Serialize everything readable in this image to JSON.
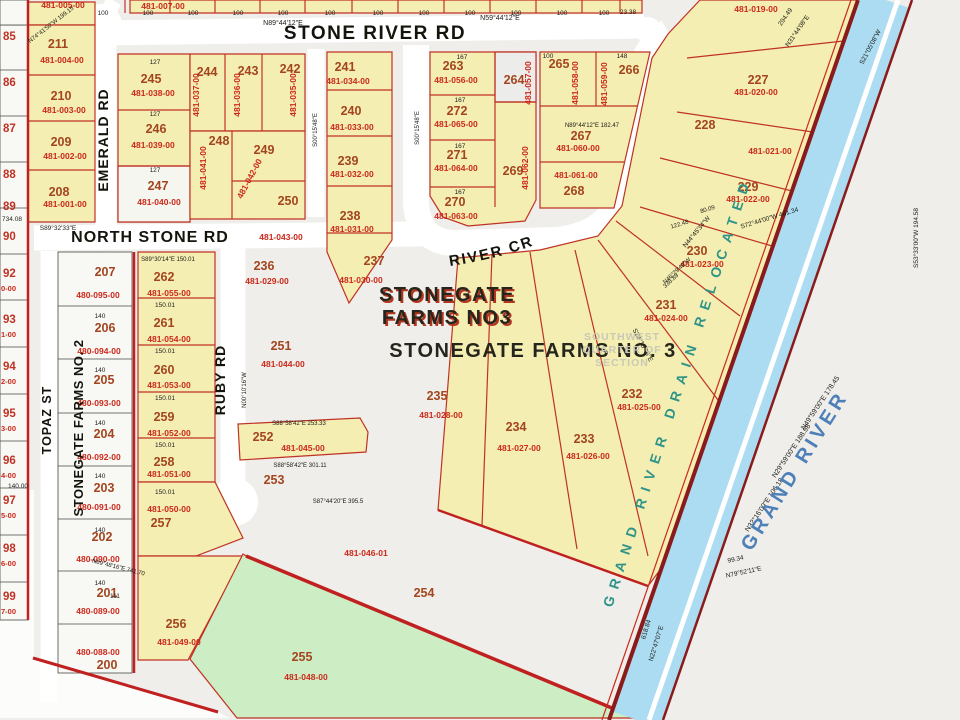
{
  "map": {
    "colors": {
      "parcel_yellow": "#f4eeb2",
      "parcel_green": "#cdeec5",
      "parcel_gray": "#ececea",
      "parcel_white": "#f8f8f5",
      "boundary_red": "#c03224",
      "thick_red": "#c02020",
      "river_blue": "#abdcf2",
      "bank_maroon": "#8b1a1a",
      "road_white": "#ffffff",
      "lot_number_color": "#a3451f",
      "parcel_id_color": "#cc291a",
      "river_label_color": "#4d80b8",
      "drain_label_color": "#2f9488"
    },
    "road_names": {
      "stone_river": "STONE RIVER RD",
      "north_stone": "NORTH STONE RD",
      "emerald": "EMERALD RD",
      "ruby": "RUBY RD",
      "topaz": "TOPAZ ST",
      "grand_river_cr": "GRAND RIVER CR"
    },
    "subdivision_labels": {
      "no3_line1": "STONEGATE",
      "no3_line2": "FARMS NO3",
      "no3_full": "STONEGATE FARMS NO. 3",
      "no2": "STONEGATE FARMS NO. 2",
      "quarter": [
        "SOUTHWEST",
        "QUARTER OF",
        "SECTION"
      ],
      "river": "GRAND RIVER",
      "drain": "GRAND RIVER DRAIN RELOCATED"
    },
    "parcels": [
      [
        "211",
        58,
        48,
        "481-004-00",
        62,
        63,
        0
      ],
      [
        "210",
        61,
        100,
        "481-003-00",
        64,
        113,
        0
      ],
      [
        "209",
        61,
        146,
        "481-002-00",
        65,
        159,
        0
      ],
      [
        "208",
        59,
        196,
        "481-001-00",
        65,
        207,
        0
      ],
      [
        "245",
        151,
        83,
        "481-038-00",
        153,
        96,
        0
      ],
      [
        "246",
        156,
        133,
        "481-039-00",
        153,
        148,
        0
      ],
      [
        "247",
        158,
        190,
        "481-040-00",
        159,
        205,
        0
      ],
      [
        "244",
        207,
        76,
        "481-037-00",
        199,
        95,
        -90
      ],
      [
        "243",
        248,
        75,
        "481-036-00",
        240,
        95,
        -90
      ],
      [
        "242",
        290,
        73,
        "481-035-00",
        296,
        95,
        -90
      ],
      [
        "248",
        219,
        145,
        "481-041-00",
        206,
        168,
        -90
      ],
      [
        "249",
        264,
        154,
        "481-042-00",
        252,
        180,
        -62
      ],
      [
        "250",
        288,
        205,
        "481-043-00",
        281,
        240,
        0
      ],
      [
        "241",
        345,
        71,
        "481-034-00",
        348,
        84,
        0
      ],
      [
        "240",
        351,
        115,
        "481-033-00",
        352,
        130,
        0
      ],
      [
        "239",
        348,
        165,
        "481-032-00",
        352,
        177,
        0
      ],
      [
        "238",
        350,
        220,
        "481-031-00",
        352,
        232,
        0
      ],
      [
        "237",
        374,
        265,
        "481-030-00",
        361,
        283,
        0
      ],
      [
        "236",
        264,
        270,
        "481-029-00",
        267,
        284,
        0
      ],
      [
        "263",
        453,
        70,
        "481-056-00",
        456,
        83,
        0
      ],
      [
        "272",
        457,
        115,
        "481-065-00",
        456,
        127,
        0
      ],
      [
        "271",
        457,
        159,
        "481-064-00",
        456,
        171,
        0
      ],
      [
        "270",
        455,
        206,
        "481-063-00",
        456,
        219,
        0
      ],
      [
        "264",
        514,
        84,
        "481-057-00",
        531,
        83,
        -90
      ],
      [
        "269",
        513,
        175,
        "481-062-00",
        528,
        168,
        -90
      ],
      [
        "265",
        559,
        68,
        "481-058-00",
        578,
        83,
        -90
      ],
      [
        "266",
        629,
        74,
        "481-059-00",
        607,
        84,
        -90
      ],
      [
        "267",
        581,
        140,
        "481-060-00",
        578,
        151,
        0
      ],
      [
        "268",
        574,
        195,
        "481-061-00",
        576,
        178,
        0
      ],
      [
        "227",
        758,
        84,
        "481-020-00",
        756,
        95,
        0
      ],
      [
        "228",
        705,
        129,
        "481-021-00",
        770,
        154,
        0
      ],
      [
        "229",
        748,
        191,
        "481-022-00",
        748,
        202,
        0
      ],
      [
        "230",
        697,
        255,
        "481-023-00",
        702,
        267,
        0
      ],
      [
        "231",
        666,
        309,
        "481-024-00",
        666,
        321,
        0
      ],
      [
        "232",
        632,
        398,
        "481-025-00",
        639,
        410,
        0
      ],
      [
        "233",
        584,
        443,
        "481-026-00",
        588,
        459,
        0
      ],
      [
        "234",
        516,
        431,
        "481-027-00",
        519,
        451,
        0
      ],
      [
        "235",
        437,
        400,
        "481-028-00",
        441,
        418,
        0
      ],
      [
        "262",
        164,
        281,
        "481-055-00",
        169,
        296,
        0
      ],
      [
        "261",
        164,
        327,
        "481-054-00",
        169,
        342,
        0
      ],
      [
        "260",
        164,
        374,
        "481-053-00",
        169,
        388,
        0
      ],
      [
        "259",
        164,
        421,
        "481-052-00",
        169,
        436,
        0
      ],
      [
        "258",
        164,
        466,
        "481-051-00",
        169,
        477,
        0
      ],
      [
        "257",
        161,
        527,
        "481-050-00",
        169,
        512,
        0
      ],
      [
        "256",
        176,
        628,
        "481-049-00",
        179,
        645,
        0
      ],
      [
        "255",
        302,
        661,
        "481-048-00",
        306,
        680,
        0
      ],
      [
        "252",
        263,
        441,
        "481-045-00",
        303,
        451,
        0
      ],
      [
        "251",
        281,
        350,
        "481-044-00",
        283,
        367,
        0
      ],
      [
        "253",
        274,
        484,
        "",
        0,
        0,
        0
      ],
      [
        "254",
        424,
        597,
        "",
        0,
        0,
        0
      ],
      [
        "207",
        105,
        276,
        "480-095-00",
        98,
        298,
        0
      ],
      [
        "206",
        105,
        332,
        "480-094-00",
        99,
        354,
        0
      ],
      [
        "205",
        104,
        384,
        "480-093-00",
        99,
        406,
        0
      ],
      [
        "204",
        104,
        438,
        "480-092-00",
        99,
        460,
        0
      ],
      [
        "203",
        104,
        492,
        "480-091-00",
        99,
        510,
        0
      ],
      [
        "202",
        102,
        541,
        "480-090-00",
        98,
        562,
        0
      ],
      [
        "201",
        107,
        597,
        "480-089-00",
        98,
        614,
        0
      ],
      [
        "200",
        107,
        669,
        "480-088-00",
        98,
        655,
        0
      ],
      [
        "",
        0,
        0,
        "481-005-00",
        63,
        8,
        0
      ],
      [
        "",
        0,
        0,
        "481-007-00",
        163,
        9,
        0
      ],
      [
        "",
        0,
        0,
        "481-019-00",
        756,
        12,
        0
      ],
      [
        "",
        0,
        0,
        "481-046-01",
        366,
        556,
        0
      ]
    ],
    "edge_lots": [
      [
        "85",
        "",
        40
      ],
      [
        "86",
        "",
        86
      ],
      [
        "87",
        "",
        132
      ],
      [
        "88",
        "",
        178
      ],
      [
        "89",
        "",
        210
      ],
      [
        "90",
        "",
        240
      ],
      [
        "92",
        "0-00",
        277
      ],
      [
        "93",
        "1-00",
        323
      ],
      [
        "94",
        "2-00",
        370
      ],
      [
        "95",
        "3-00",
        417
      ],
      [
        "96",
        "4-00",
        464
      ],
      [
        "97",
        "5-00",
        504
      ],
      [
        "98",
        "6-00",
        552
      ],
      [
        "99",
        "7-00",
        600
      ]
    ],
    "top_ticks": [
      103,
      148,
      193,
      238,
      283,
      330,
      378,
      424,
      470,
      516,
      562,
      604
    ],
    "tick_label": "100",
    "bearings": [
      [
        "N59°44'12\"E",
        500,
        20,
        0,
        7
      ],
      [
        "N89°44'12\"E",
        283,
        25,
        0,
        7
      ],
      [
        "N74°41'50\"W 199.15",
        52,
        26,
        -38,
        6
      ],
      [
        "S89°32'33\"E",
        58,
        230,
        0,
        6.5
      ],
      [
        "S89°30'14\"E  150.01",
        168,
        261,
        0,
        6
      ],
      [
        "23.38",
        628,
        14,
        0,
        6.5
      ],
      [
        "294.49",
        787,
        18,
        -55,
        6.5
      ],
      [
        "N31°44'08\"E",
        799,
        32,
        -55,
        6.5
      ],
      [
        "S21°05'08\"W",
        872,
        48,
        -62,
        6.5
      ],
      [
        "S72°44'00\"W 481.34",
        770,
        220,
        -17,
        6.5
      ],
      [
        "N44°45'34\"W",
        698,
        233,
        -50,
        6.5
      ],
      [
        "122.48",
        680,
        226,
        -17,
        6
      ],
      [
        "80.09",
        708,
        211,
        -17,
        6
      ],
      [
        "N46°29'48\"W",
        678,
        272,
        -43,
        6
      ],
      [
        "338.89",
        672,
        282,
        -43,
        6
      ],
      [
        "S23°15'45\"E",
        641,
        346,
        62,
        6.5
      ],
      [
        "N32°16'00\"E  106.18",
        766,
        506,
        -56,
        7
      ],
      [
        "N29°59'00\"E  188.98",
        793,
        452,
        -56,
        7
      ],
      [
        "N49°59'00\"E  178.45",
        822,
        404,
        -56,
        7
      ],
      [
        "99.34",
        736,
        561,
        -12,
        6.5
      ],
      [
        "N79°52'11\"E",
        744,
        574,
        -12,
        6.5
      ],
      [
        "618.84",
        648,
        630,
        -73,
        6.5
      ],
      [
        "N22°47'07\"E",
        658,
        644,
        -73,
        6.5
      ],
      [
        "S53°33'00\"W 194.58",
        918,
        238,
        -90,
        6.5
      ],
      [
        "S87°44'20\"E 395.5",
        338,
        503,
        0,
        6
      ],
      [
        "S88°58'42\"E 253.33",
        299,
        425,
        0,
        6
      ],
      [
        "S88°58'42\"E 301.11",
        300,
        467,
        0,
        6
      ],
      [
        "N89°48'16\"E 741.70",
        118,
        569,
        14,
        6
      ],
      [
        "N00°10'16\"W",
        246,
        390,
        -90,
        6
      ],
      [
        "S00°15'48\"E",
        317,
        130,
        -90,
        6
      ],
      [
        "S00°15'48\"E",
        419,
        128,
        -90,
        6
      ],
      [
        "N89°44'12\"E 182.47",
        592,
        127,
        0,
        6
      ]
    ],
    "dims": [
      [
        "150.01",
        165,
        307
      ],
      [
        "150.01",
        165,
        353
      ],
      [
        "150.01",
        165,
        400
      ],
      [
        "150.01",
        165,
        447
      ],
      [
        "150.01",
        165,
        494
      ],
      [
        "140",
        100,
        318
      ],
      [
        "140",
        100,
        372
      ],
      [
        "140",
        100,
        425
      ],
      [
        "140",
        100,
        478
      ],
      [
        "140",
        100,
        532
      ],
      [
        "140",
        100,
        585
      ],
      [
        "127",
        155,
        64
      ],
      [
        "127",
        155,
        116
      ],
      [
        "127",
        155,
        172
      ],
      [
        "167",
        462,
        59
      ],
      [
        "167",
        460,
        102
      ],
      [
        "167",
        460,
        148
      ],
      [
        "167",
        460,
        194
      ],
      [
        "100",
        548,
        58
      ],
      [
        "148",
        622,
        58
      ],
      [
        "111",
        115,
        598
      ],
      [
        "734.08",
        12,
        221
      ],
      [
        "140.00",
        18,
        488
      ]
    ],
    "labels": [
      {
        "t": "STONE RIVER RD",
        "x": 375,
        "y": 39,
        "fs": 19,
        "ls": 1.5,
        "cls": "roadname",
        "dn": "road-label-stone-river-rd"
      },
      {
        "t": "NORTH STONE RD",
        "x": 150,
        "y": 242,
        "fs": 16,
        "ls": 1,
        "cls": "roadname",
        "dn": "road-label-north-stone-rd"
      },
      {
        "t": "EMERALD RD",
        "x": 108,
        "y": 140,
        "r": -90,
        "fs": 14,
        "ls": 1,
        "cls": "roadname",
        "dn": "road-label-emerald-rd"
      },
      {
        "t": "RUBY RD",
        "x": 225,
        "y": 380,
        "r": -90,
        "fs": 14,
        "ls": 1,
        "cls": "roadname",
        "dn": "road-label-ruby-rd"
      },
      {
        "t": "TOPAZ ST",
        "x": 51,
        "y": 420,
        "r": -90,
        "fs": 12.5,
        "ls": 1,
        "cls": "roadname",
        "dn": "road-label-topaz-st"
      },
      {
        "t": "STONEGATE FARMS NO. 2",
        "x": 83,
        "y": 428,
        "r": -90,
        "fs": 13,
        "ls": 0.5,
        "cls": "roadname",
        "dn": "subdivision-2-label"
      },
      {
        "t": "STONEGATE",
        "x": 449,
        "y": 303,
        "cls": "sub3red",
        "dn": "subdivision-3-label-shadow"
      },
      {
        "t": "STONEGATE",
        "x": 447,
        "y": 301,
        "cls": "sub3",
        "dn": "subdivision-3-label"
      },
      {
        "t": "FARMS NO3",
        "x": 449,
        "y": 326,
        "cls": "sub3red",
        "dn": "subdivision-3-label-shadow"
      },
      {
        "t": "FARMS NO3",
        "x": 447,
        "y": 324,
        "cls": "sub3",
        "dn": "subdivision-3-label"
      },
      {
        "t": "STONEGATE FARMS NO. 3",
        "x": 533,
        "y": 357,
        "fs": 20,
        "ls": 1.5,
        "cls": "sub3",
        "dn": "subdivision-3-full-label"
      },
      {
        "t": "SOUTHWEST",
        "x": 622,
        "y": 340,
        "cls": "quarter",
        "dn": "quarter-section-label"
      },
      {
        "t": "QUARTER OF",
        "x": 622,
        "y": 353,
        "cls": "quarter",
        "dn": "quarter-section-label"
      },
      {
        "t": "SECTION",
        "x": 622,
        "y": 366,
        "cls": "quarter",
        "dn": "quarter-section-label"
      },
      {
        "t": "GRAND RIVER",
        "x": 800,
        "y": 474,
        "r": -58,
        "cls": "riverlbl",
        "dn": "river-label"
      },
      {
        "t": "GRAND RIVER DRAIN RELOCATED",
        "x": 612,
        "y": 608,
        "r": -72,
        "ls": 8,
        "cls": "drain",
        "anchor": "start",
        "dn": "drain-label"
      }
    ]
  }
}
